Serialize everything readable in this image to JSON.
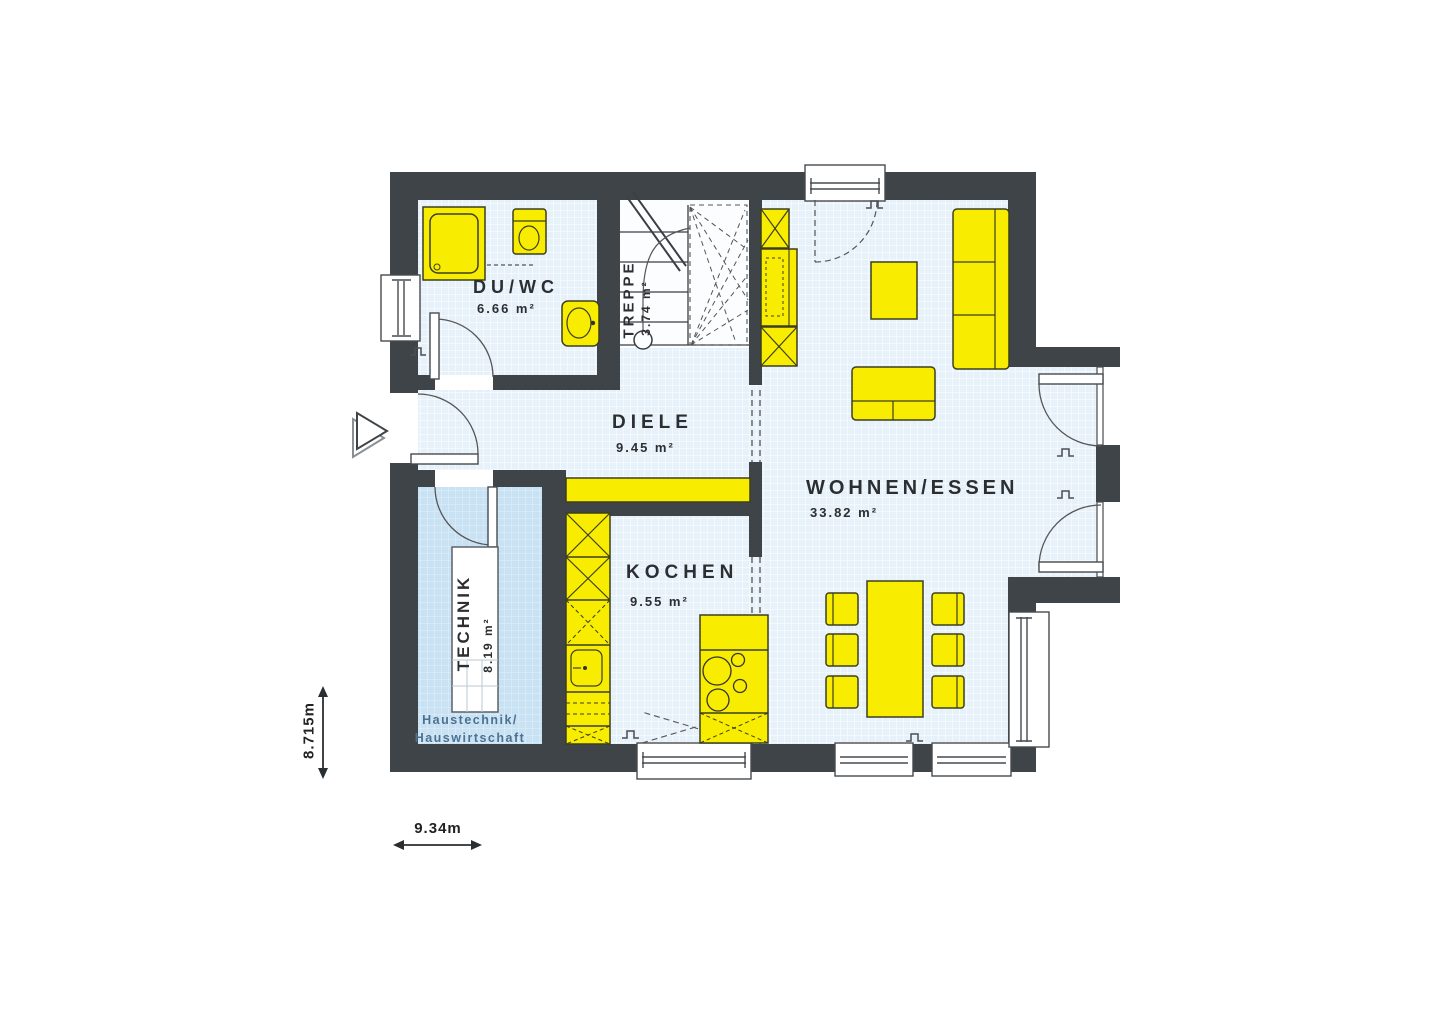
{
  "plan": {
    "rooms": {
      "duwc": {
        "name": "DU/WC",
        "area": "6.66 m²"
      },
      "treppe": {
        "name": "TREPPE",
        "area": "3.74 m²"
      },
      "diele": {
        "name": "DIELE",
        "area": "9.45 m²"
      },
      "technik": {
        "name": "TECHNIK",
        "area": "8.19 m²",
        "note_line1": "Haustechnik/",
        "note_line2": "Hauswirtschaft"
      },
      "kochen": {
        "name": "KOCHEN",
        "area": "9.55 m²"
      },
      "wohnen_essen": {
        "name": "WOHNEN/ESSEN",
        "area": "33.82 m²"
      }
    },
    "dimensions": {
      "height": "8.715m",
      "width": "9.34m"
    },
    "colors": {
      "wall": "#3f4449",
      "floor": "#e6f1fa",
      "floor_technik": "#c8e2f3",
      "furniture": "#f8ed00",
      "stairs_bg": "#fbfdfe",
      "note_text": "#4d7191",
      "label_text": "#2c2f31"
    }
  }
}
